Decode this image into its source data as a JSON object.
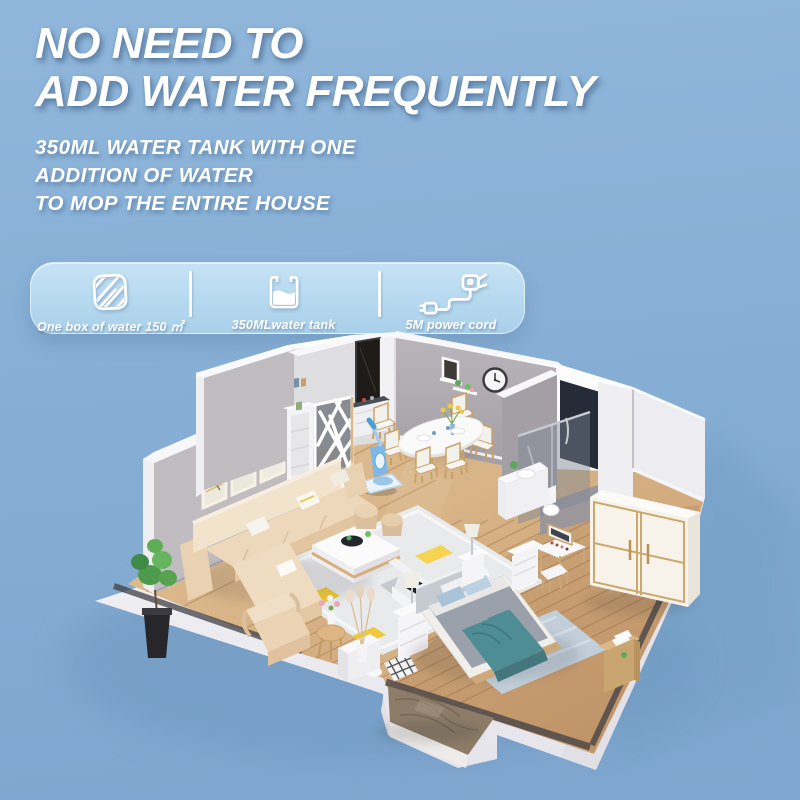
{
  "heading": {
    "line1": "NO NEED TO",
    "line2": "ADD WATER FREQUENTLY",
    "color": "#FFFFFF"
  },
  "subheading": {
    "line1": "350ML WATER TANK WITH ONE",
    "line2": "ADDITION OF WATER",
    "line3": "TO MOP THE ENTIRE HOUSE"
  },
  "feature_bar": {
    "background": "#B4D8EF",
    "items": [
      {
        "icon": "mop-pad-icon",
        "label": "One box of water 150 ㎡"
      },
      {
        "icon": "water-tank-icon",
        "label": "350MLwater tank"
      },
      {
        "icon": "power-cord-icon",
        "label": "5M power cord"
      }
    ]
  },
  "illustration": {
    "name": "isometric-apartment-cutaway",
    "colors": {
      "background": "#87AFD5",
      "shadow": "#6F98C0",
      "wall": "#C0BCC0",
      "wall_light": "#EDEDF1",
      "floor_wood": "#D7B286",
      "floor_wood_dark": "#C09468",
      "sofa": "#EDD8BB",
      "rug": "#E9EAEC",
      "rug_accent": "#F1CC3B",
      "bed_mattress": "#9BA1AA",
      "bed_blanket": "#4F8D95",
      "bed_rug": "#C2CFDB",
      "wardrobe": "#F7F3EB",
      "wardrobe_trim": "#CBA86C",
      "marble": "#8D7D68",
      "mop_blue": "#7FB7E8",
      "plant": "#4E9B4E"
    }
  }
}
